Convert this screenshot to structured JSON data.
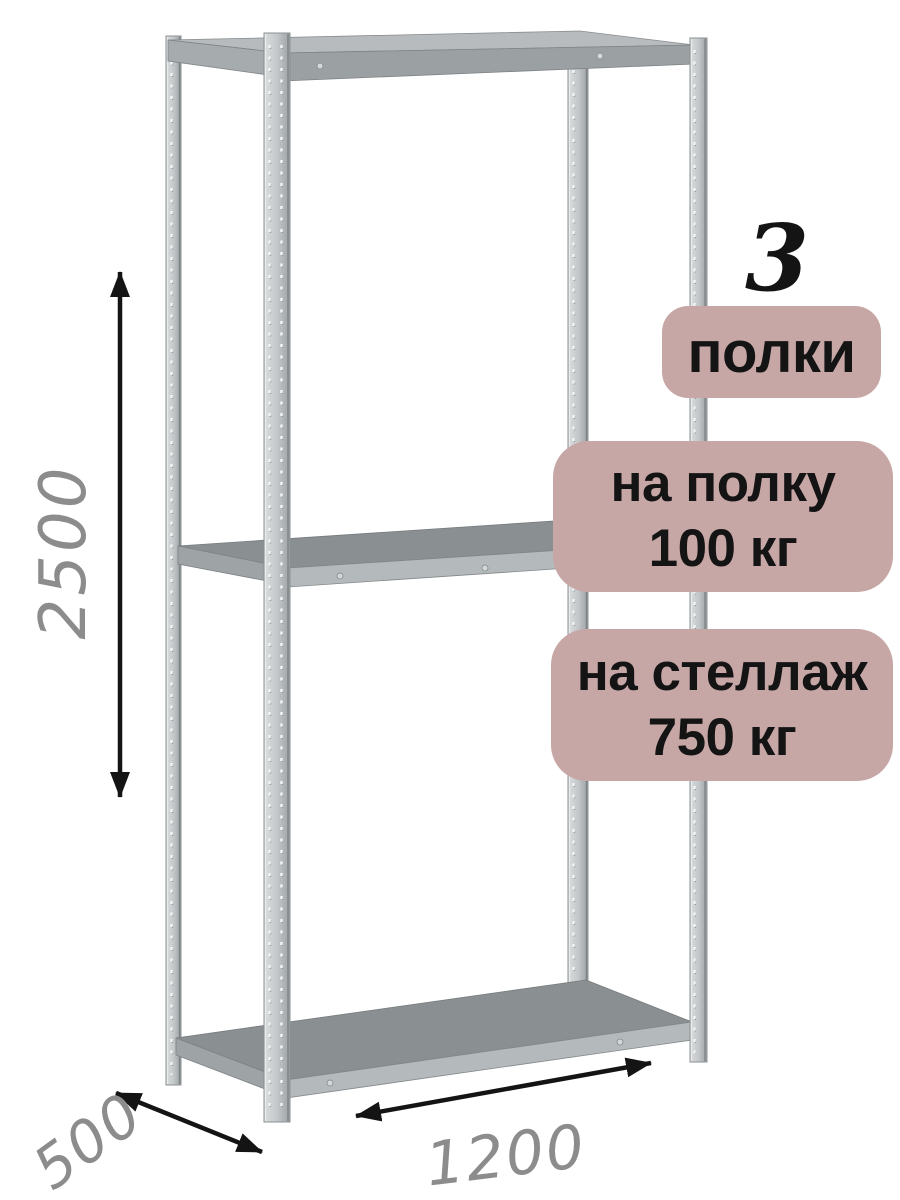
{
  "badges": {
    "shelves": {
      "count": "3",
      "label": "полки"
    },
    "per_shelf": {
      "line1": "на полку",
      "line2": "100 кг"
    },
    "per_rack": {
      "line1": "на стеллаж",
      "line2": "750 кг"
    }
  },
  "dimensions": {
    "height_mm": "2500",
    "depth_mm": "500",
    "width_mm": "1200"
  },
  "colors": {
    "badge_bg": "#c7a7a6",
    "badge_text": "#141414",
    "dimension_text": "#8c8c8c",
    "arrow": "#141414",
    "metal_light": "#d8dbdc",
    "metal_dark": "#9ca1a4",
    "shelf_top": "#8a8f91",
    "shelf_face": "#b4b9bb"
  }
}
